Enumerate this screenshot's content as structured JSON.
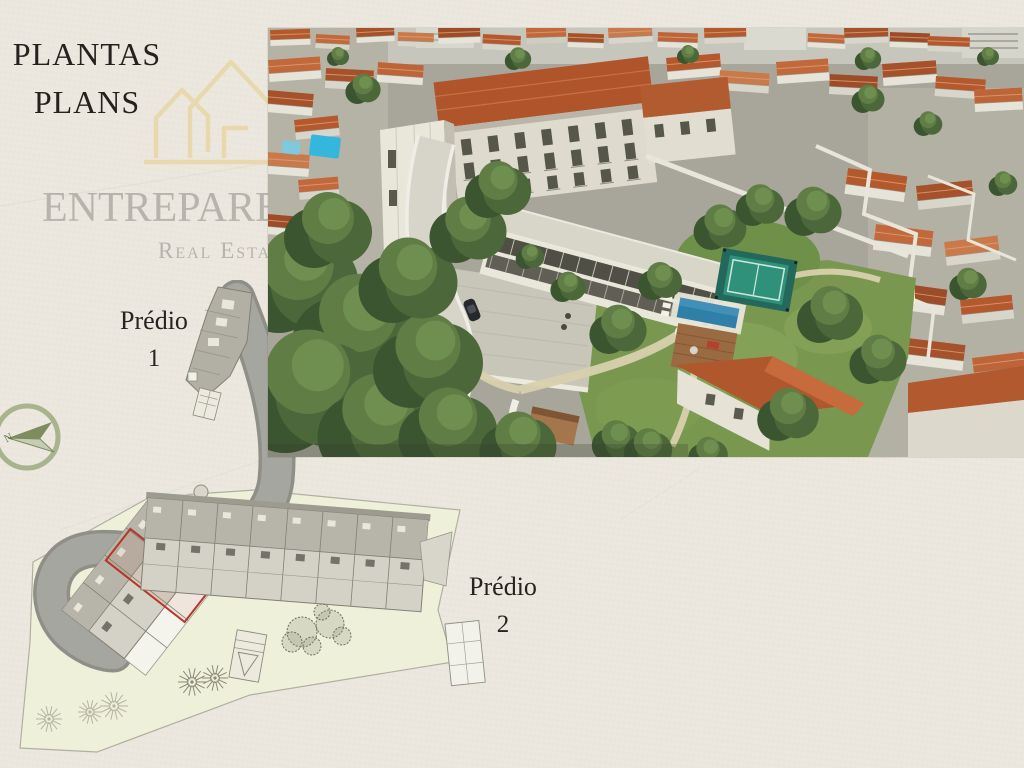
{
  "slide": {
    "title": "PLANTAS",
    "subtitle": "PLANS"
  },
  "logo": {
    "brand": "ENTREPAREDES",
    "tagline": "Real Estate"
  },
  "site_plan": {
    "building1": {
      "label": "Prédio",
      "number": "1"
    },
    "building2": {
      "label": "Prédio",
      "number": "2"
    },
    "compass_north": "N"
  },
  "colors": {
    "background": "#ece8df",
    "title_text": "#26211e",
    "watermark_gray": "#b7b3ad",
    "logo_gold": "#e7d7a9",
    "compass_green": "#a9b48e",
    "plan_site_fill": "#eef0d9",
    "plan_road_gray": "#a2a29e",
    "highlight_red": "#b5362a",
    "roof_terracotta": "#b4582e",
    "garden_green": "#7a9750",
    "pool_blue": "#2f7fa8"
  }
}
